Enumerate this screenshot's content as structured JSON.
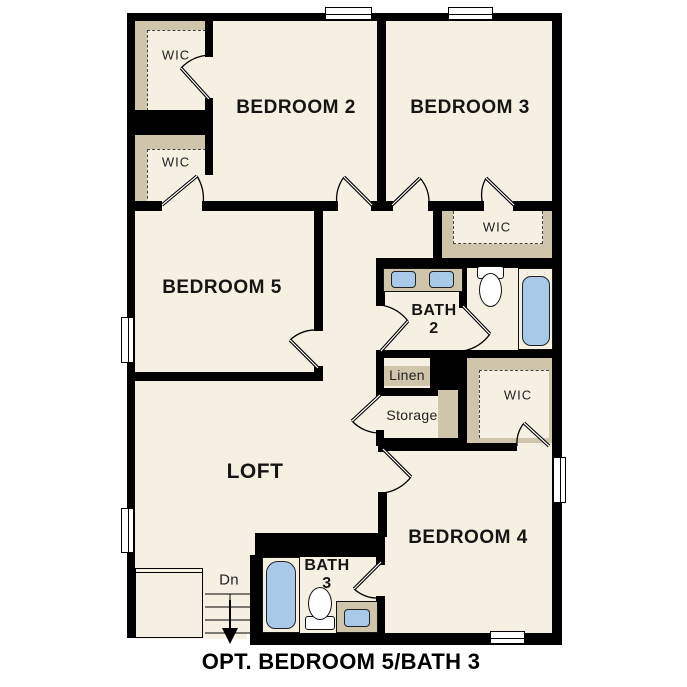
{
  "floorplan": {
    "caption": "OPT. BEDROOM 5/BATH 3",
    "labels": {
      "bedroom2": "BEDROOM 2",
      "bedroom3": "BEDROOM 3",
      "bedroom4": "BEDROOM 4",
      "bedroom5": "BEDROOM 5",
      "loft": "LOFT",
      "bath": "BATH",
      "bath2_num": "2",
      "bath3_num": "3",
      "wic": "WIC",
      "linen": "Linen",
      "storage": "Storage",
      "down": "Dn"
    },
    "colors": {
      "wall": "#000000",
      "floor": "#f6f0e3",
      "closet_shelf": "#cec5aa",
      "fixture_blue": "#a9c9e8",
      "window": "#ffffff"
    }
  }
}
